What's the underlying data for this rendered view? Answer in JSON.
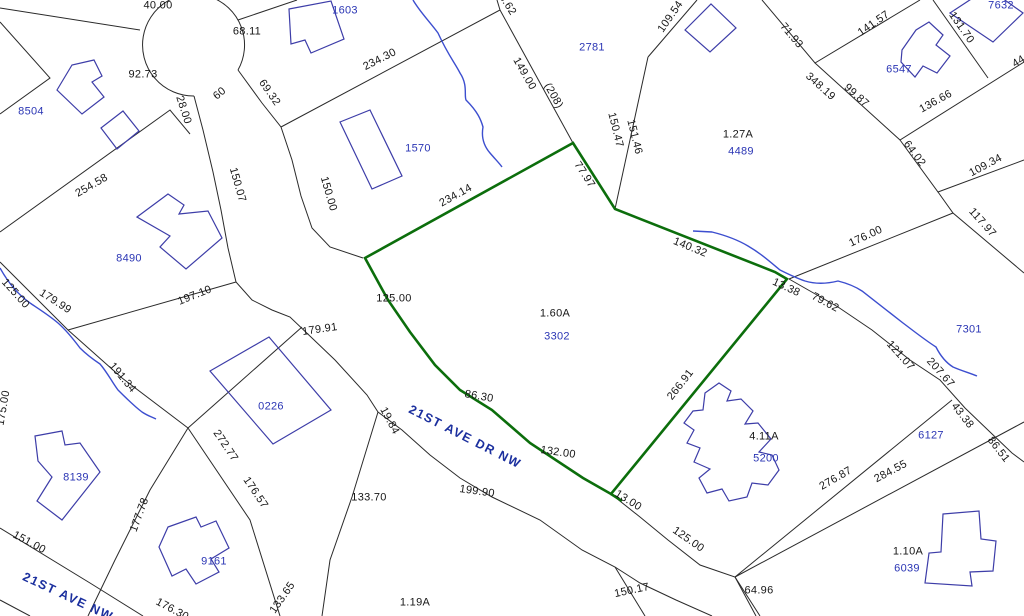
{
  "map": {
    "type": "parcel-plat-map",
    "colors": {
      "background": "#ffffff",
      "lot_line": "#2a2a2a",
      "highlight_parcel": "#0c6e0c",
      "creek": "#3c4ecf",
      "building": "#3d3da8",
      "parcel_id_text": "#2a35b4",
      "dimension_text": "#161616",
      "street_text": "#1b2f9e"
    },
    "highlighted_parcel": {
      "id": "3302",
      "area": "1.60A"
    },
    "street_names": [
      "21ST AVE DR NW",
      "21ST AVE NW"
    ],
    "parcel_ids": [
      "8504",
      "1603",
      "1570",
      "2781",
      "4489",
      "7632",
      "6547",
      "8490",
      "3302",
      "7301",
      "0226",
      "8139",
      "9161",
      "5200",
      "6127",
      "6039"
    ],
    "area_labels": [
      "1.27A",
      "1.60A",
      "4.11A",
      "1.19A",
      "1.10A"
    ],
    "labels": [
      {
        "t": "40.00",
        "x": 158,
        "y": 6,
        "r": 0,
        "k": "dim"
      },
      {
        "t": "68.11",
        "x": 247,
        "y": 32,
        "r": 0,
        "k": "dim"
      },
      {
        "t": "92.73",
        "x": 143,
        "y": 75,
        "r": 0,
        "k": "dim"
      },
      {
        "t": "60",
        "x": 220,
        "y": 94,
        "r": -40,
        "k": "dim"
      },
      {
        "t": "28.00",
        "x": 183,
        "y": 110,
        "r": 72,
        "k": "dim"
      },
      {
        "t": "69.32",
        "x": 269,
        "y": 93,
        "r": 55,
        "k": "dim"
      },
      {
        "t": "150.07",
        "x": 237,
        "y": 185,
        "r": 74,
        "k": "dim"
      },
      {
        "t": "254.58",
        "x": 92,
        "y": 186,
        "r": -30,
        "k": "dim"
      },
      {
        "t": "234.30",
        "x": 380,
        "y": 60,
        "r": -27,
        "k": "dim"
      },
      {
        "t": "150.00",
        "x": 328,
        "y": 194,
        "r": 74,
        "k": "dim"
      },
      {
        "t": "3.62",
        "x": 507,
        "y": 5,
        "r": 58,
        "k": "dim"
      },
      {
        "t": "149.00",
        "x": 524,
        "y": 74,
        "r": 60,
        "k": "dim"
      },
      {
        "t": "(208)",
        "x": 553,
        "y": 96,
        "r": 60,
        "k": "dim"
      },
      {
        "t": "109.54",
        "x": 671,
        "y": 17,
        "r": -55,
        "k": "dim"
      },
      {
        "t": "150.47",
        "x": 615,
        "y": 130,
        "r": 76,
        "k": "dim"
      },
      {
        "t": "151.46",
        "x": 634,
        "y": 137,
        "r": 76,
        "k": "dim"
      },
      {
        "t": "77.97",
        "x": 584,
        "y": 175,
        "r": 57,
        "k": "dim"
      },
      {
        "t": "71.93",
        "x": 791,
        "y": 36,
        "r": 50,
        "k": "dim"
      },
      {
        "t": "141.57",
        "x": 874,
        "y": 24,
        "r": -35,
        "k": "dim"
      },
      {
        "t": "131.70",
        "x": 961,
        "y": 28,
        "r": 55,
        "k": "dim"
      },
      {
        "t": "348.19",
        "x": 820,
        "y": 87,
        "r": 42,
        "k": "dim"
      },
      {
        "t": "99.87",
        "x": 856,
        "y": 96,
        "r": 42,
        "k": "dim"
      },
      {
        "t": "136.66",
        "x": 936,
        "y": 102,
        "r": -29,
        "k": "dim"
      },
      {
        "t": "44",
        "x": 1019,
        "y": 62,
        "r": -32,
        "k": "dim"
      },
      {
        "t": "64.02",
        "x": 914,
        "y": 154,
        "r": 53,
        "k": "dim"
      },
      {
        "t": "109.34",
        "x": 986,
        "y": 166,
        "r": -28,
        "k": "dim"
      },
      {
        "t": "1.27A",
        "x": 738,
        "y": 135,
        "r": 0,
        "k": "dim"
      },
      {
        "t": "234.14",
        "x": 456,
        "y": 196,
        "r": -29,
        "k": "dim"
      },
      {
        "t": "140.32",
        "x": 690,
        "y": 248,
        "r": 22,
        "k": "dim"
      },
      {
        "t": "176.00",
        "x": 866,
        "y": 237,
        "r": -25,
        "k": "dim"
      },
      {
        "t": "117.97",
        "x": 982,
        "y": 223,
        "r": 48,
        "k": "dim"
      },
      {
        "t": "13.38",
        "x": 786,
        "y": 288,
        "r": 25,
        "k": "dim"
      },
      {
        "t": "79.62",
        "x": 825,
        "y": 303,
        "r": 28,
        "k": "dim"
      },
      {
        "t": "121.07",
        "x": 900,
        "y": 356,
        "r": 48,
        "k": "dim"
      },
      {
        "t": "207.67",
        "x": 940,
        "y": 373,
        "r": 48,
        "k": "dim"
      },
      {
        "t": "7301",
        "x": 969,
        "y": 330,
        "r": 0,
        "k": "pid"
      },
      {
        "t": "125.00",
        "x": 394,
        "y": 299,
        "r": 0,
        "k": "dim"
      },
      {
        "t": "1.60A",
        "x": 555,
        "y": 314,
        "r": 0,
        "k": "dim"
      },
      {
        "t": "3302",
        "x": 557,
        "y": 337,
        "r": 0,
        "k": "pid"
      },
      {
        "t": "86.30",
        "x": 479,
        "y": 397,
        "r": 10,
        "k": "dim"
      },
      {
        "t": "266.91",
        "x": 681,
        "y": 385,
        "r": -52,
        "k": "dim"
      },
      {
        "t": "43.38",
        "x": 962,
        "y": 416,
        "r": 52,
        "k": "dim"
      },
      {
        "t": "86.51",
        "x": 998,
        "y": 450,
        "r": 52,
        "k": "dim"
      },
      {
        "t": "276.87",
        "x": 836,
        "y": 479,
        "r": -30,
        "k": "dim"
      },
      {
        "t": "284.55",
        "x": 891,
        "y": 472,
        "r": -28,
        "k": "dim"
      },
      {
        "t": "4.11A",
        "x": 764,
        "y": 437,
        "r": 0,
        "k": "dim"
      },
      {
        "t": "5200",
        "x": 766,
        "y": 459,
        "r": 0,
        "k": "pid"
      },
      {
        "t": "6127",
        "x": 931,
        "y": 436,
        "r": 0,
        "k": "pid"
      },
      {
        "t": "132.00",
        "x": 558,
        "y": 453,
        "r": 8,
        "k": "dim"
      },
      {
        "t": "13.00",
        "x": 628,
        "y": 501,
        "r": 32,
        "k": "dim"
      },
      {
        "t": "125.00",
        "x": 688,
        "y": 540,
        "r": 35,
        "k": "dim"
      },
      {
        "t": "199.90",
        "x": 477,
        "y": 492,
        "r": 8,
        "k": "dim"
      },
      {
        "t": "19.84",
        "x": 389,
        "y": 421,
        "r": 62,
        "k": "dim"
      },
      {
        "t": "133.70",
        "x": 369,
        "y": 498,
        "r": 0,
        "k": "dim"
      },
      {
        "t": "179.91",
        "x": 320,
        "y": 330,
        "r": -8,
        "k": "dim"
      },
      {
        "t": "197.10",
        "x": 195,
        "y": 296,
        "r": -22,
        "k": "dim"
      },
      {
        "t": "125.00",
        "x": 15,
        "y": 294,
        "r": 48,
        "k": "dim"
      },
      {
        "t": "179.99",
        "x": 55,
        "y": 302,
        "r": 33,
        "k": "dim"
      },
      {
        "t": "191.34",
        "x": 122,
        "y": 378,
        "r": 50,
        "k": "dim"
      },
      {
        "t": "272.77",
        "x": 225,
        "y": 446,
        "r": 56,
        "k": "dim"
      },
      {
        "t": "176.57",
        "x": 255,
        "y": 493,
        "r": 56,
        "k": "dim"
      },
      {
        "t": "177.78",
        "x": 140,
        "y": 515,
        "r": -70,
        "k": "dim"
      },
      {
        "t": "175.00",
        "x": 4,
        "y": 408,
        "r": -80,
        "k": "dim"
      },
      {
        "t": "151.00",
        "x": 29,
        "y": 543,
        "r": 28,
        "k": "dim"
      },
      {
        "t": "133.65",
        "x": 283,
        "y": 598,
        "r": -55,
        "k": "dim"
      },
      {
        "t": "176.30",
        "x": 172,
        "y": 610,
        "r": 28,
        "k": "dim"
      },
      {
        "t": "150.17",
        "x": 632,
        "y": 591,
        "r": -12,
        "k": "dim"
      },
      {
        "t": "64.96",
        "x": 759,
        "y": 591,
        "r": 0,
        "k": "dim"
      },
      {
        "t": "1.19A",
        "x": 415,
        "y": 603,
        "r": 0,
        "k": "dim"
      },
      {
        "t": "1.10A",
        "x": 908,
        "y": 552,
        "r": 0,
        "k": "dim"
      },
      {
        "t": "8504",
        "x": 31,
        "y": 112,
        "r": 0,
        "k": "pid"
      },
      {
        "t": "1603",
        "x": 345,
        "y": 11,
        "r": 0,
        "k": "pid"
      },
      {
        "t": "1570",
        "x": 418,
        "y": 149,
        "r": 0,
        "k": "pid"
      },
      {
        "t": "2781",
        "x": 592,
        "y": 48,
        "r": 0,
        "k": "pid"
      },
      {
        "t": "4489",
        "x": 741,
        "y": 152,
        "r": 0,
        "k": "pid"
      },
      {
        "t": "7632",
        "x": 1001,
        "y": 6,
        "r": 0,
        "k": "pid"
      },
      {
        "t": "6547",
        "x": 899,
        "y": 70,
        "r": 0,
        "k": "pid"
      },
      {
        "t": "8490",
        "x": 129,
        "y": 259,
        "r": 0,
        "k": "pid"
      },
      {
        "t": "0226",
        "x": 271,
        "y": 407,
        "r": 0,
        "k": "pid"
      },
      {
        "t": "8139",
        "x": 76,
        "y": 478,
        "r": 0,
        "k": "pid"
      },
      {
        "t": "9161",
        "x": 214,
        "y": 562,
        "r": 0,
        "k": "pid"
      },
      {
        "t": "6039",
        "x": 907,
        "y": 569,
        "r": 0,
        "k": "pid"
      },
      {
        "t": "21ST AVE DR NW",
        "x": 465,
        "y": 437,
        "r": 27,
        "k": "street"
      },
      {
        "t": "21ST AVE NW",
        "x": 68,
        "y": 597,
        "r": 25,
        "k": "street"
      }
    ]
  }
}
